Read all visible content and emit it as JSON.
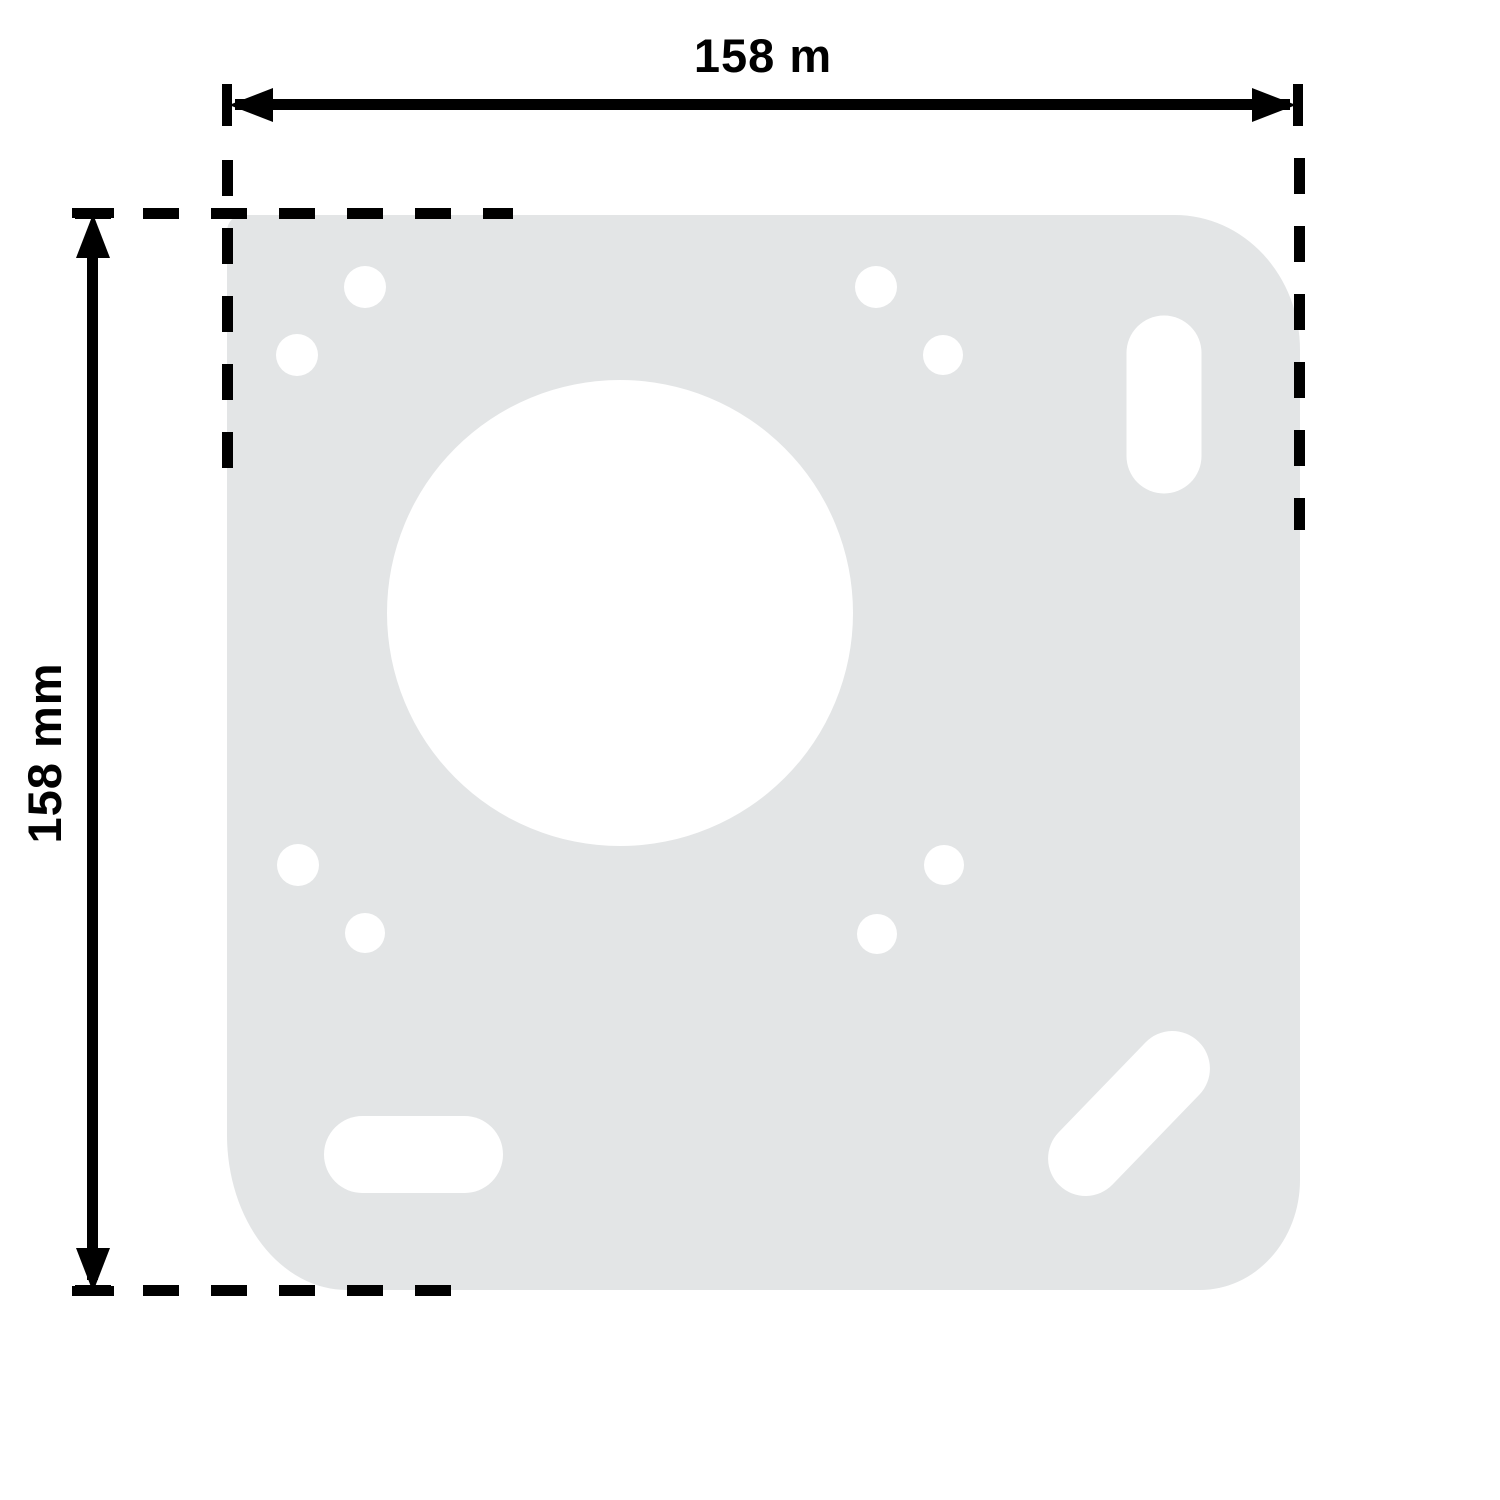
{
  "diagram": {
    "kind": "technical-dimension-drawing",
    "part": "mounting-plate",
    "colors": {
      "background": "#ffffff",
      "plate_fill": "#e3e5e6",
      "line_color": "#000000"
    },
    "dimensions": {
      "horizontal": {
        "label": "158 m"
      },
      "vertical": {
        "label": "158 mm"
      }
    },
    "plate": {
      "x": 227,
      "y": 215,
      "width": 1073,
      "height": 1075,
      "holes": {
        "circles": [
          {
            "name": "screw-hole-top-left-a",
            "cx": 365,
            "cy": 287,
            "r": 21
          },
          {
            "name": "screw-hole-top-left-b",
            "cx": 297,
            "cy": 355,
            "r": 21
          },
          {
            "name": "screw-hole-top-right-a",
            "cx": 876,
            "cy": 287,
            "r": 21
          },
          {
            "name": "screw-hole-top-right-b",
            "cx": 943,
            "cy": 355,
            "r": 20
          },
          {
            "name": "screw-hole-mid-left-a",
            "cx": 298,
            "cy": 865,
            "r": 21
          },
          {
            "name": "screw-hole-mid-left-b",
            "cx": 365,
            "cy": 933,
            "r": 20
          },
          {
            "name": "screw-hole-mid-right-a",
            "cx": 944,
            "cy": 865,
            "r": 20
          },
          {
            "name": "screw-hole-mid-right-b",
            "cx": 877,
            "cy": 934,
            "r": 20
          },
          {
            "name": "center-hole",
            "cx": 620,
            "cy": 613,
            "r": 233
          }
        ],
        "slots": [
          {
            "name": "slot-hole-top-right",
            "cx": 1164,
            "cy": 404,
            "length": 178,
            "width": 75,
            "angle": 90
          },
          {
            "name": "slot-hole-bottom-left",
            "cx": 413,
            "cy": 1154,
            "length": 179,
            "width": 77,
            "angle": 0
          },
          {
            "name": "slot-hole-bottom-right",
            "cx": 1129,
            "cy": 1113,
            "length": 200,
            "width": 75,
            "angle": -46
          }
        ]
      }
    }
  }
}
